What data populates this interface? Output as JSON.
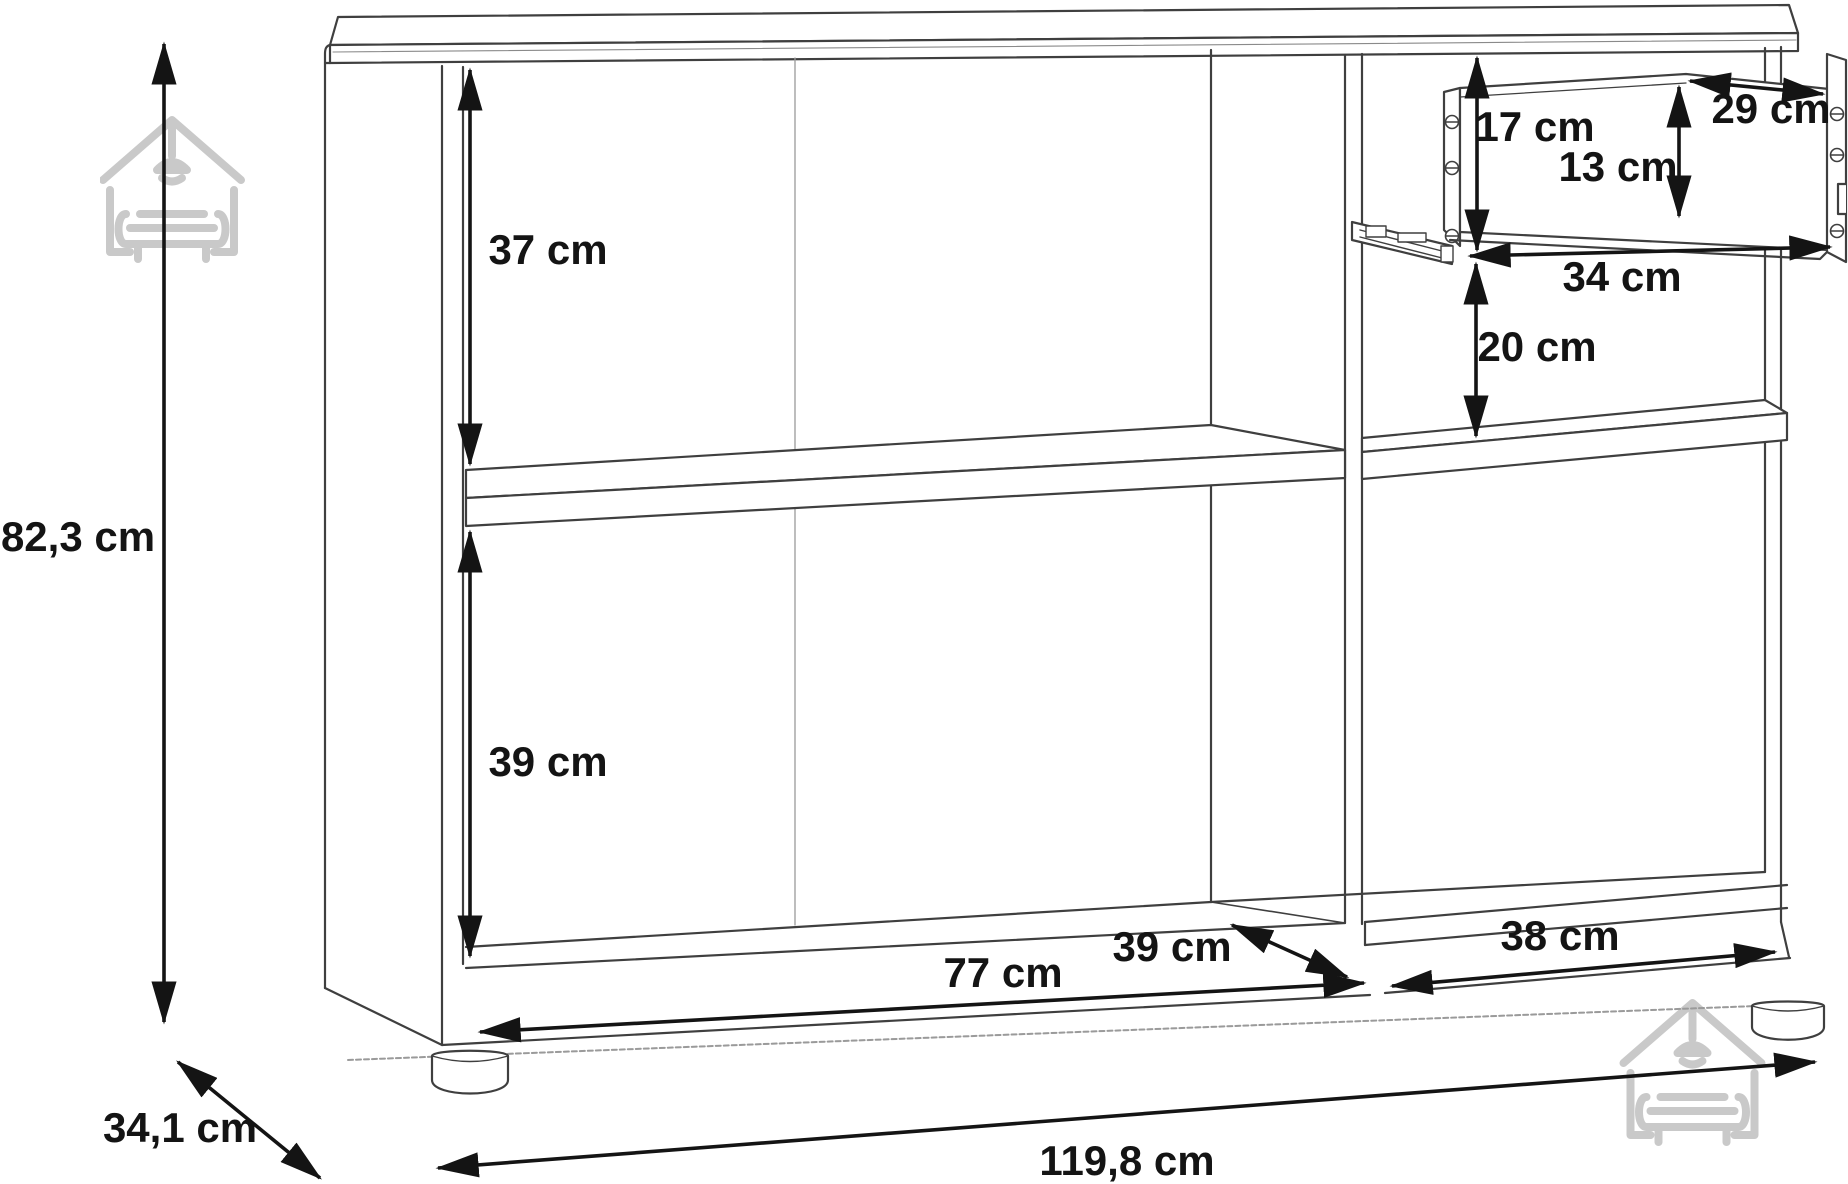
{
  "title": "Sideboard dimensional line drawing",
  "unit": "cm",
  "colors": {
    "cabinet_line": "#3f3f3f",
    "thin_line": "#9a9a9a",
    "dimension_line": "#141414",
    "watermark": "#c9c9c9",
    "background": "#ffffff"
  },
  "labels": {
    "overall_height": "82,3 cm",
    "overall_depth": "34,1 cm",
    "overall_width": "119,8 cm",
    "upper_left_compartment_height": "37 cm",
    "lower_left_compartment_height": "39 cm",
    "left_compartment_width": "77 cm",
    "compartment_depth": "39 cm",
    "right_compartment_width": "38 cm",
    "drawer_opening_height": "17 cm",
    "drawer_inner_height": "13 cm",
    "drawer_depth": "29 cm",
    "drawer_width": "34 cm",
    "below_drawer_clearance": "20 cm"
  },
  "watermark": {
    "icon_name": "house-sofa-logo"
  }
}
